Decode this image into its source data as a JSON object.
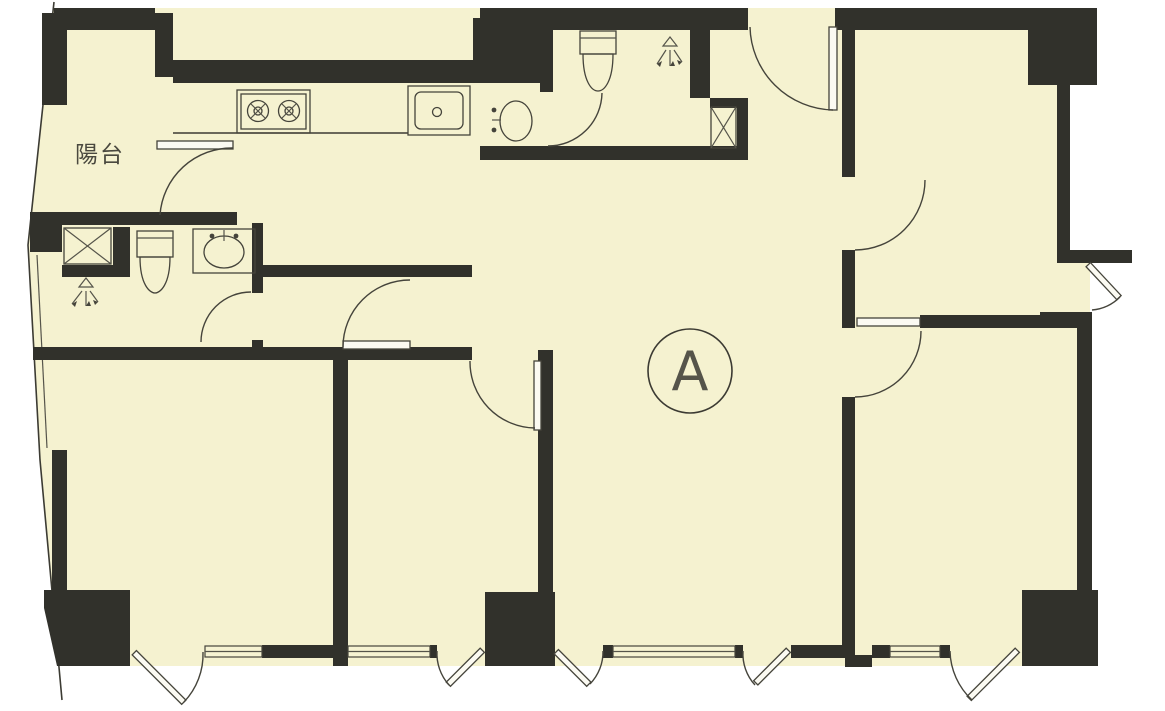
{
  "meta": {
    "type": "architectural-floor-plan",
    "description": "Scanned apartment floor plan, unit A, pale yellow floor fill with thick dark walls"
  },
  "labels": {
    "balcony": "陽台",
    "unit": "A"
  },
  "colors": {
    "paper": "#ffffff",
    "floor": "#f5f2d0",
    "wall": "#31312b",
    "line": "#45443b"
  },
  "fixtures": [
    {
      "id": "stove",
      "name": "two-burner-stove",
      "room": "kitchen"
    },
    {
      "id": "kitchen-sink",
      "name": "kitchen-sink",
      "room": "kitchen"
    },
    {
      "id": "washbasin-nook",
      "name": "washbasin",
      "room": "wash-area"
    },
    {
      "id": "toilet-top",
      "name": "toilet",
      "room": "bathroom-top"
    },
    {
      "id": "shower-top",
      "name": "shower-spray-symbol",
      "room": "bathroom-top"
    },
    {
      "id": "duct-top",
      "name": "pipe-duct-x-box",
      "room": "bathroom-top"
    },
    {
      "id": "toilet-left",
      "name": "toilet",
      "room": "bathroom-left"
    },
    {
      "id": "shower-left",
      "name": "shower-spray-symbol",
      "room": "bathroom-left"
    },
    {
      "id": "duct-left",
      "name": "pipe-duct-x-box",
      "room": "bathroom-left"
    },
    {
      "id": "washbasin-left",
      "name": "washbasin",
      "room": "bathroom-left"
    }
  ],
  "counts": {
    "door-swing-arcs": 12,
    "windows-bottom": 4,
    "entry-door-right": 1
  }
}
